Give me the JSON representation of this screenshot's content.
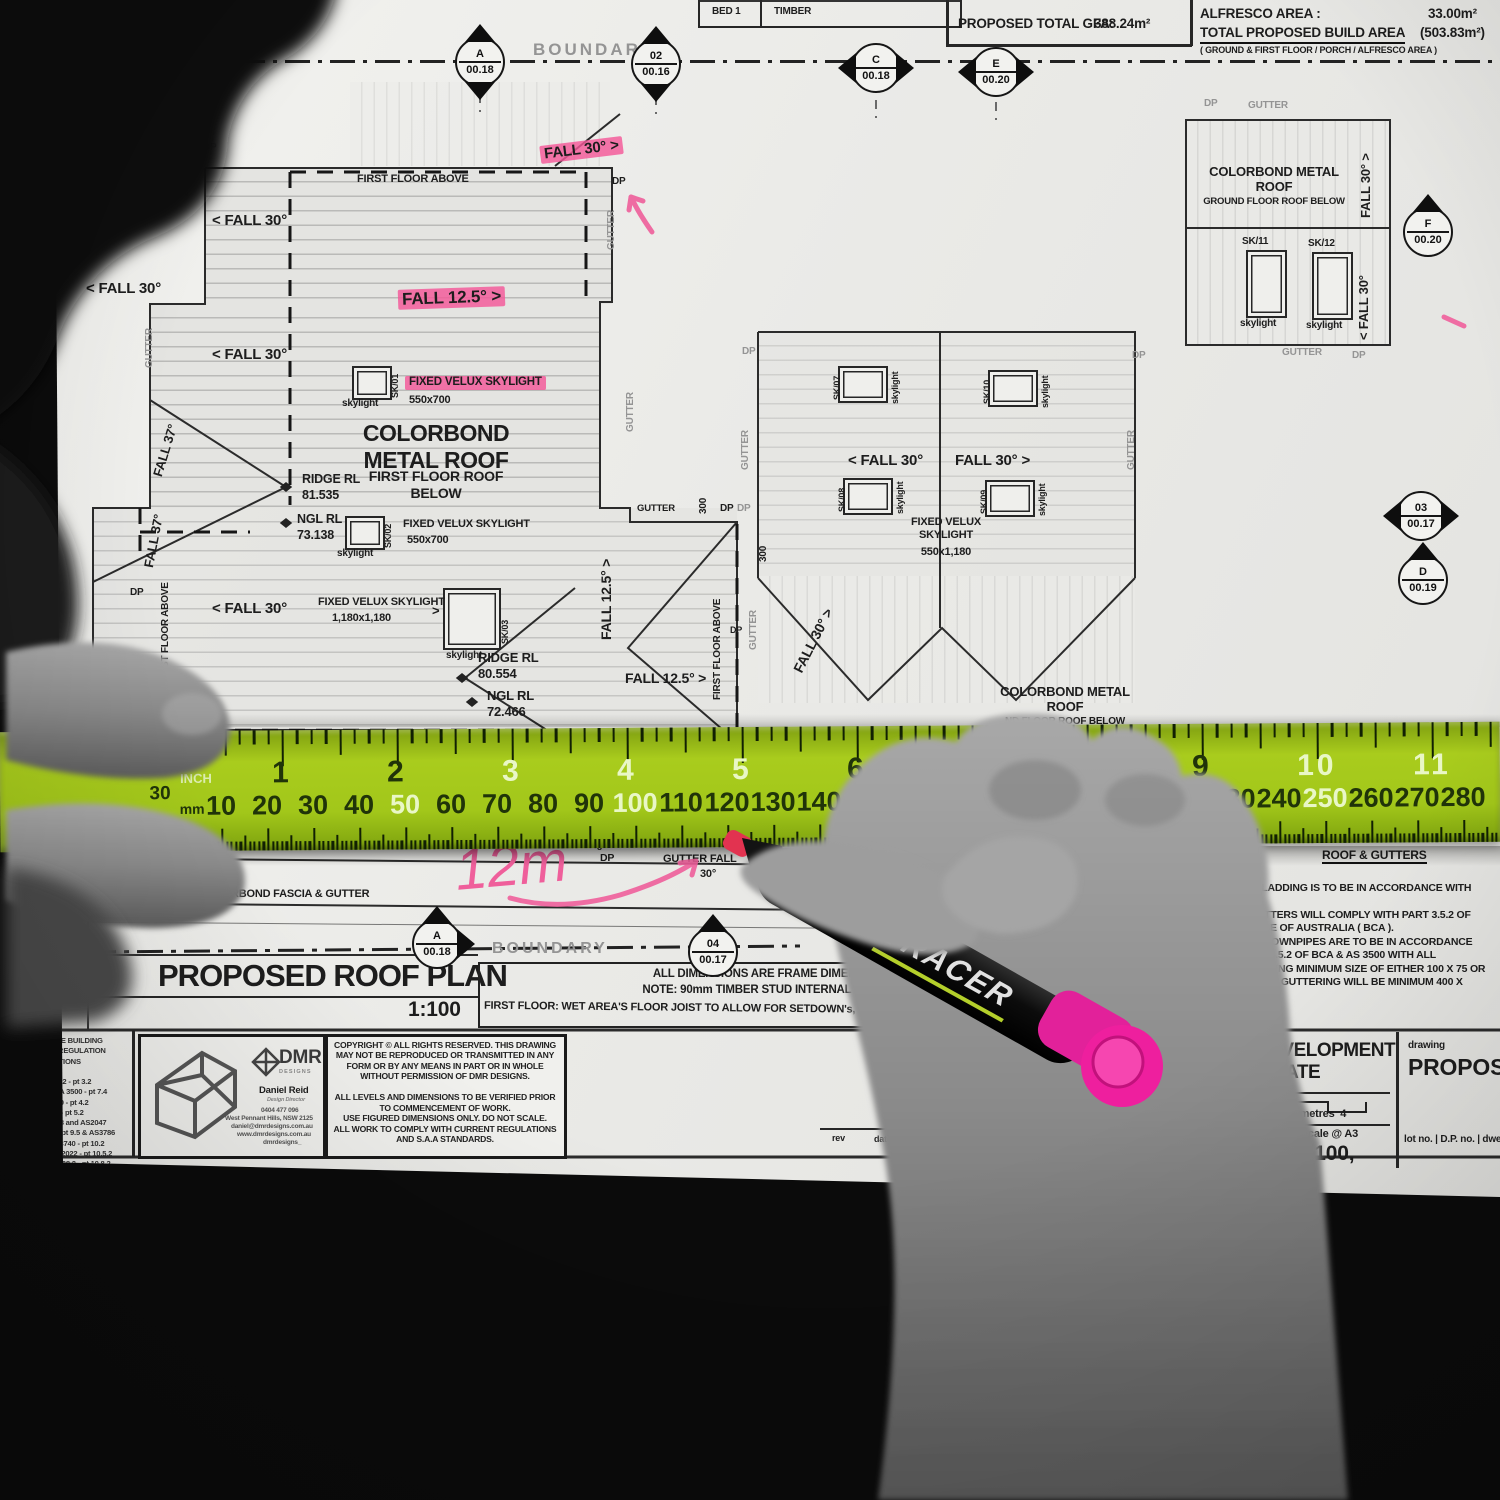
{
  "photo": {
    "marker_brand": "TRACER",
    "annotation": "12m"
  },
  "header": {
    "bed": "BED 1",
    "timber": "TIMBER",
    "excl": "EXCLUDING VOID",
    "gfa_label": "PROPOSED TOTAL GFA:",
    "gfa_value": "388.24m²",
    "alfresco_label": "ALFRESCO AREA :",
    "alfresco_value": "33.00m²",
    "build_label": "TOTAL PROPOSED BUILD AREA",
    "build_value": "(503.83m²)",
    "build_note": "( GROUND & FIRST FLOOR / PORCH / ALFRESCO AREA )"
  },
  "boundary_label": "BOUNDARY",
  "markers": {
    "a1": {
      "id": "A",
      "v": "00.18"
    },
    "m02": {
      "id": "02",
      "v": "00.16"
    },
    "c": {
      "id": "C",
      "v": "00.18"
    },
    "e": {
      "id": "E",
      "v": "00.20"
    },
    "f": {
      "id": "F",
      "v": "00.20"
    },
    "m03": {
      "id": "03",
      "v": "00.17"
    },
    "d": {
      "id": "D",
      "v": "00.19"
    },
    "a2": {
      "id": "A",
      "v": "00.18"
    },
    "m04": {
      "id": "04",
      "v": "00.17"
    }
  },
  "plan": {
    "first_floor_above": "FIRST FLOOR ABOVE",
    "st_floor_above": "ST FLOOR ABOVE",
    "gutter": "GUTTER",
    "dp": "DP",
    "dim_300": "300",
    "dim_200": "200",
    "num_8": "8",
    "fall_30_l": "< FALL 30°",
    "fall_30_r": "FALL 30° >",
    "fall_30": "FALL 30°",
    "fall_125_r": "FALL 12.5° >",
    "fall_125": "FALL 12.5°",
    "fall_37": "FALL 37°",
    "skylight": "skylight",
    "sk01": "SK/01",
    "sk02": "SK/02",
    "sk03": "SK/03",
    "sk07": "SK/07",
    "sk08": "SK/08",
    "sk09": "SK/09",
    "sk10": "SK/10",
    "sk11": "SK/11",
    "sk12": "SK/12",
    "velux": "FIXED VELUX SKYLIGHT",
    "velux2": "FIXED VELUX\nSKYLIGHT",
    "size_550x700": "550x700",
    "size_1180": "1,180x1,180",
    "size_550x1180": "550x1,180",
    "colorbond_first": "COLORBOND\nMETAL ROOF",
    "colorbond_first_sub": "FIRST FLOOR ROOF\nBELOW",
    "colorbond_ground": "COLORBOND METAL\nROOF",
    "colorbond_ground_sub": "GROUND FLOOR ROOF BELOW",
    "colorbond_ground_sub2": "ND FLOOR ROOF BELOW",
    "ridge_rl": "RIDGE RL",
    "ngl_rl": "NGL RL",
    "ridge1": "81.535",
    "ngl1": "73.138",
    "ridge2": "80.554",
    "ngl2": "72.466",
    "gutter_fall": "GUTTER FALL",
    "deg30": "30°",
    "fascia": "COLORBOND FASCIA & GUTTER"
  },
  "notes_right": {
    "heading": "ROOF & GUTTERS",
    "body": "-ALL ROOF CLADDING IS TO BE IN ACCORDANCE WITH\nAS.1562.1\n- ALL BOX GUTTERS WILL COMPLY WITH PART 3.5.2 OF\nBUILDING COSE OF AUSTRALIA ( BCA ).\n- GUTTERS & DOWNPIPES ARE TO BE IN ACCORDANCE\nWITH CLAUSE 3.5.2 OF BCA & AS 3500 WITH ALL\nDOWNPIPES BEING MINIMUM SIZE OF EITHER 100 X 75 OR\nODIA & ALL BOX GUTTERING WILL BE MINIMUM 400 X"
  },
  "plan_title": {
    "title": "PROPOSED ROOF PLAN",
    "scale": "1:100"
  },
  "note_box": {
    "l1": "ALL DIMENSIONS ARE FRAME DIMENSIONS",
    "l2": "NOTE: 90mm TIMBER STUD INTERNAL FRAMES",
    "l3": "FIRST FLOOR: WET AREA'S FLOOR JOIST TO ALLOW FOR SETDOWN's, refer to eng's"
  },
  "ruler": {
    "inch_label": "INCH",
    "mm_label": "mm",
    "edge": "30",
    "inches": [
      "1",
      "2",
      "3",
      "4",
      "5",
      "6",
      "7",
      "8",
      "9",
      "10",
      "11"
    ],
    "inch_dark": [
      "1",
      "2",
      "6",
      "9"
    ],
    "mm": [
      "10",
      "20",
      "30",
      "40",
      "50",
      "60",
      "70",
      "80",
      "90",
      "100",
      "110",
      "120",
      "130",
      "140",
      "150",
      "160",
      "170",
      "180",
      "190",
      "200",
      "210",
      "220",
      "230",
      "240",
      "250",
      "260",
      "270",
      "280"
    ],
    "mm_light": [
      "50",
      "100",
      "150",
      "200",
      "250"
    ]
  },
  "titleblock": {
    "compliance": "STANDARDS. THE BUILDING\nRY AND LOCAL REGULATION\nS AND INSTRUCTIONS\n\nLY WITH BCA 2022 - pt 3.2\nPLY WITH AS/NZA 3500 - pt 7.4\nPLY WITH AS2870 - pt 4.2\nLY WITH AS3700 - pt 5.2\nPLY WITH AS1288 and AS2047\nMPLY WITH BCA pt 9.5 & AS3786\nOMPLY WITH AS3740 - pt 10.2\nMPLY WITH BCA 2022 - pt 10.5.2\nMPLY WITH AS1668.2 - pt 10.8.2\nOMPLY WITH BCA 2022 - pt 11.2",
    "dmr": {
      "brand": "DMR",
      "brand_sub": "D E S I G N S",
      "name": "Daniel Reid",
      "role": "Design Director",
      "phone": "0404 477 096",
      "addr": "West Pennant Hills, NSW 2125",
      "email": "daniel@dmrdesigns.com.au",
      "web": "www.dmrdesigns.com.au",
      "social": "dmrdesigns_"
    },
    "copyright": "COPYRIGHT © ALL RIGHTS RESERVED. THIS DRAWING\nMAY NOT BE REPRODUCED OR TRANSMITTED IN ANY\nFORM OR BY ANY MEANS IN PART OR IN WHOLE\nWITHOUT PERMISSION OF DMR DESIGNS.\n\nALL LEVELS AND DIMENSIONS TO BE VERIFIED PRIOR\nTO COMMENCEMENT OF WORK.\nUSE FIGURED DIMENSIONS ONLY. DO NOT SCALE.\nALL WORK TO COMPLY WITH CURRENT REGULATIONS\nAND S.A.A STANDARDS.",
    "rev": "rev",
    "date": "date",
    "dev_line1": "DEVELOPMENT",
    "dev_line2": "FICATE",
    "scalebar": "3  metres  4",
    "scale_at": "scale @ A3",
    "scale_val": "1:100,",
    "drawing_label": "drawing",
    "drawing_val": "PROPOSED",
    "lot": "lot no. | D.P. no. | dwellin"
  }
}
